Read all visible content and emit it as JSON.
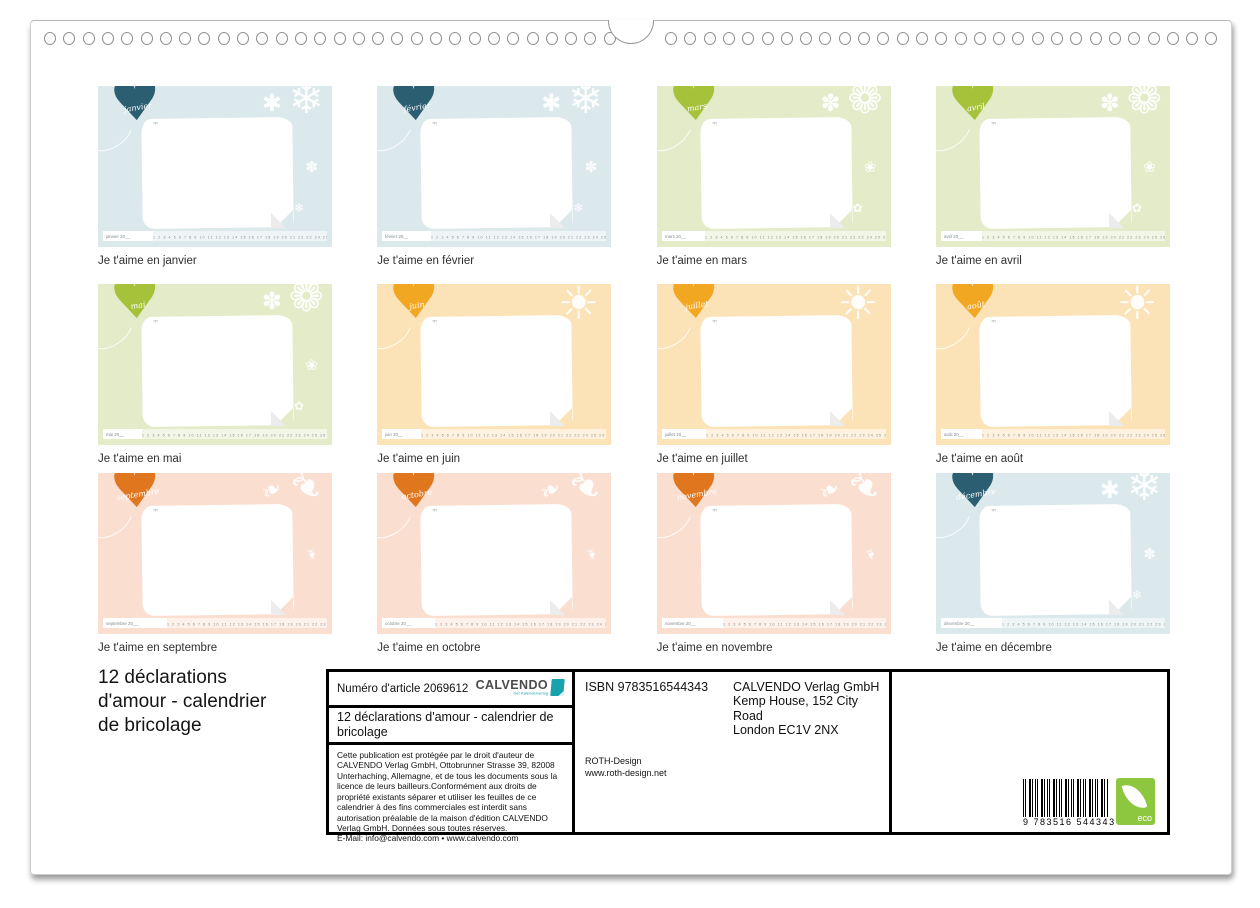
{
  "binding": {
    "left_rings": 30,
    "right_rings": 29
  },
  "icons": {
    "quote": "””"
  },
  "themes": {
    "winter": {
      "bg": "#dbe8ec",
      "heart": "#2b5e70",
      "glyphs": [
        "❄",
        "✱",
        "✽",
        "❄"
      ]
    },
    "spring": {
      "bg": "#e3ebc8",
      "heart": "#a6c13a",
      "glyphs": [
        "❁",
        "✽",
        "❀",
        "✿"
      ]
    },
    "summer": {
      "bg": "#fce3b7",
      "heart": "#f2a723",
      "glyphs": [
        "☀",
        "",
        "",
        ""
      ]
    },
    "autumn": {
      "bg": "#fadfd1",
      "heart": "#e0771f",
      "glyphs": [
        "❧",
        "❧",
        "❧",
        ""
      ]
    }
  },
  "strip_days": "1 2 3 4 5 6 7 8 9 10 11 12 13 14 15 16 17 18 19 20 21 22 23 24 25 26 27 28 29 30 31",
  "months": [
    {
      "name": "janvier",
      "theme": "winter",
      "caption": "Je t'aime en janvier",
      "strip_label": "janvier 20__"
    },
    {
      "name": "février",
      "theme": "winter",
      "caption": "Je t'aime en février",
      "strip_label": "février 20__"
    },
    {
      "name": "mars",
      "theme": "spring",
      "caption": "Je t'aime en mars",
      "strip_label": "mars 20__"
    },
    {
      "name": "avril",
      "theme": "spring",
      "caption": "Je t'aime en avril",
      "strip_label": "avril 20__"
    },
    {
      "name": "mai",
      "theme": "spring",
      "caption": "Je t'aime en mai",
      "strip_label": "mai 20__"
    },
    {
      "name": "juin",
      "theme": "summer",
      "caption": "Je t'aime en juin",
      "strip_label": "juin 20__"
    },
    {
      "name": "juillet",
      "theme": "summer",
      "caption": "Je t'aime en juillet",
      "strip_label": "juillet 20__"
    },
    {
      "name": "août",
      "theme": "summer",
      "caption": "Je t'aime en août",
      "strip_label": "août 20__"
    },
    {
      "name": "septembre",
      "theme": "autumn",
      "caption": "Je t'aime en septembre",
      "strip_label": "septembre 20__"
    },
    {
      "name": "octobre",
      "theme": "autumn",
      "caption": "Je t'aime en octobre",
      "strip_label": "octobre 20__"
    },
    {
      "name": "novembre",
      "theme": "autumn",
      "caption": "Je t'aime en novembre",
      "strip_label": "novembre 20__"
    },
    {
      "name": "décembre",
      "theme": "winter",
      "caption": "Je t'aime en décembre",
      "strip_label": "décembre 20__"
    }
  ],
  "footer": {
    "title_lines": [
      "12 déclarations",
      "d'amour - calendrier",
      "de bricolage"
    ],
    "article_number": "Numéro d'article 2069612",
    "brand": "CALVENDO",
    "brand_tagline": "Der Kalenderverlag",
    "product_title": "12 déclarations d'amour - calendrier de bricolage",
    "copyright": "Cette publication est protégée par le droit d'auteur de CALVENDO Verlag GmbH, Ottobrunner Strasse 39, 82008 Unterhaching,  Allemagne, et de tous les documents sous la licence de leurs bailleurs.Conformément aux droits de propriété existants séparer et utiliser les feuilles de ce calendrier à des fins commerciales est interdit sans autorisation préalable de la maison d'édition  CALVENDO Verlag GmbH. Données sous toutes réserves.",
    "email_line": "E-Mail: info@calvendo.com • www.calvendo.com",
    "isbn": "ISBN 9783516544343",
    "publisher_lines": [
      "CALVENDO Verlag GmbH",
      "Kemp House, 152 City Road",
      "London EC1V 2NX"
    ],
    "designer_lines": [
      "ROTH-Design",
      "www.roth-design.net"
    ],
    "barcode_number": "9 783516 544343",
    "eco_label": "eco"
  }
}
